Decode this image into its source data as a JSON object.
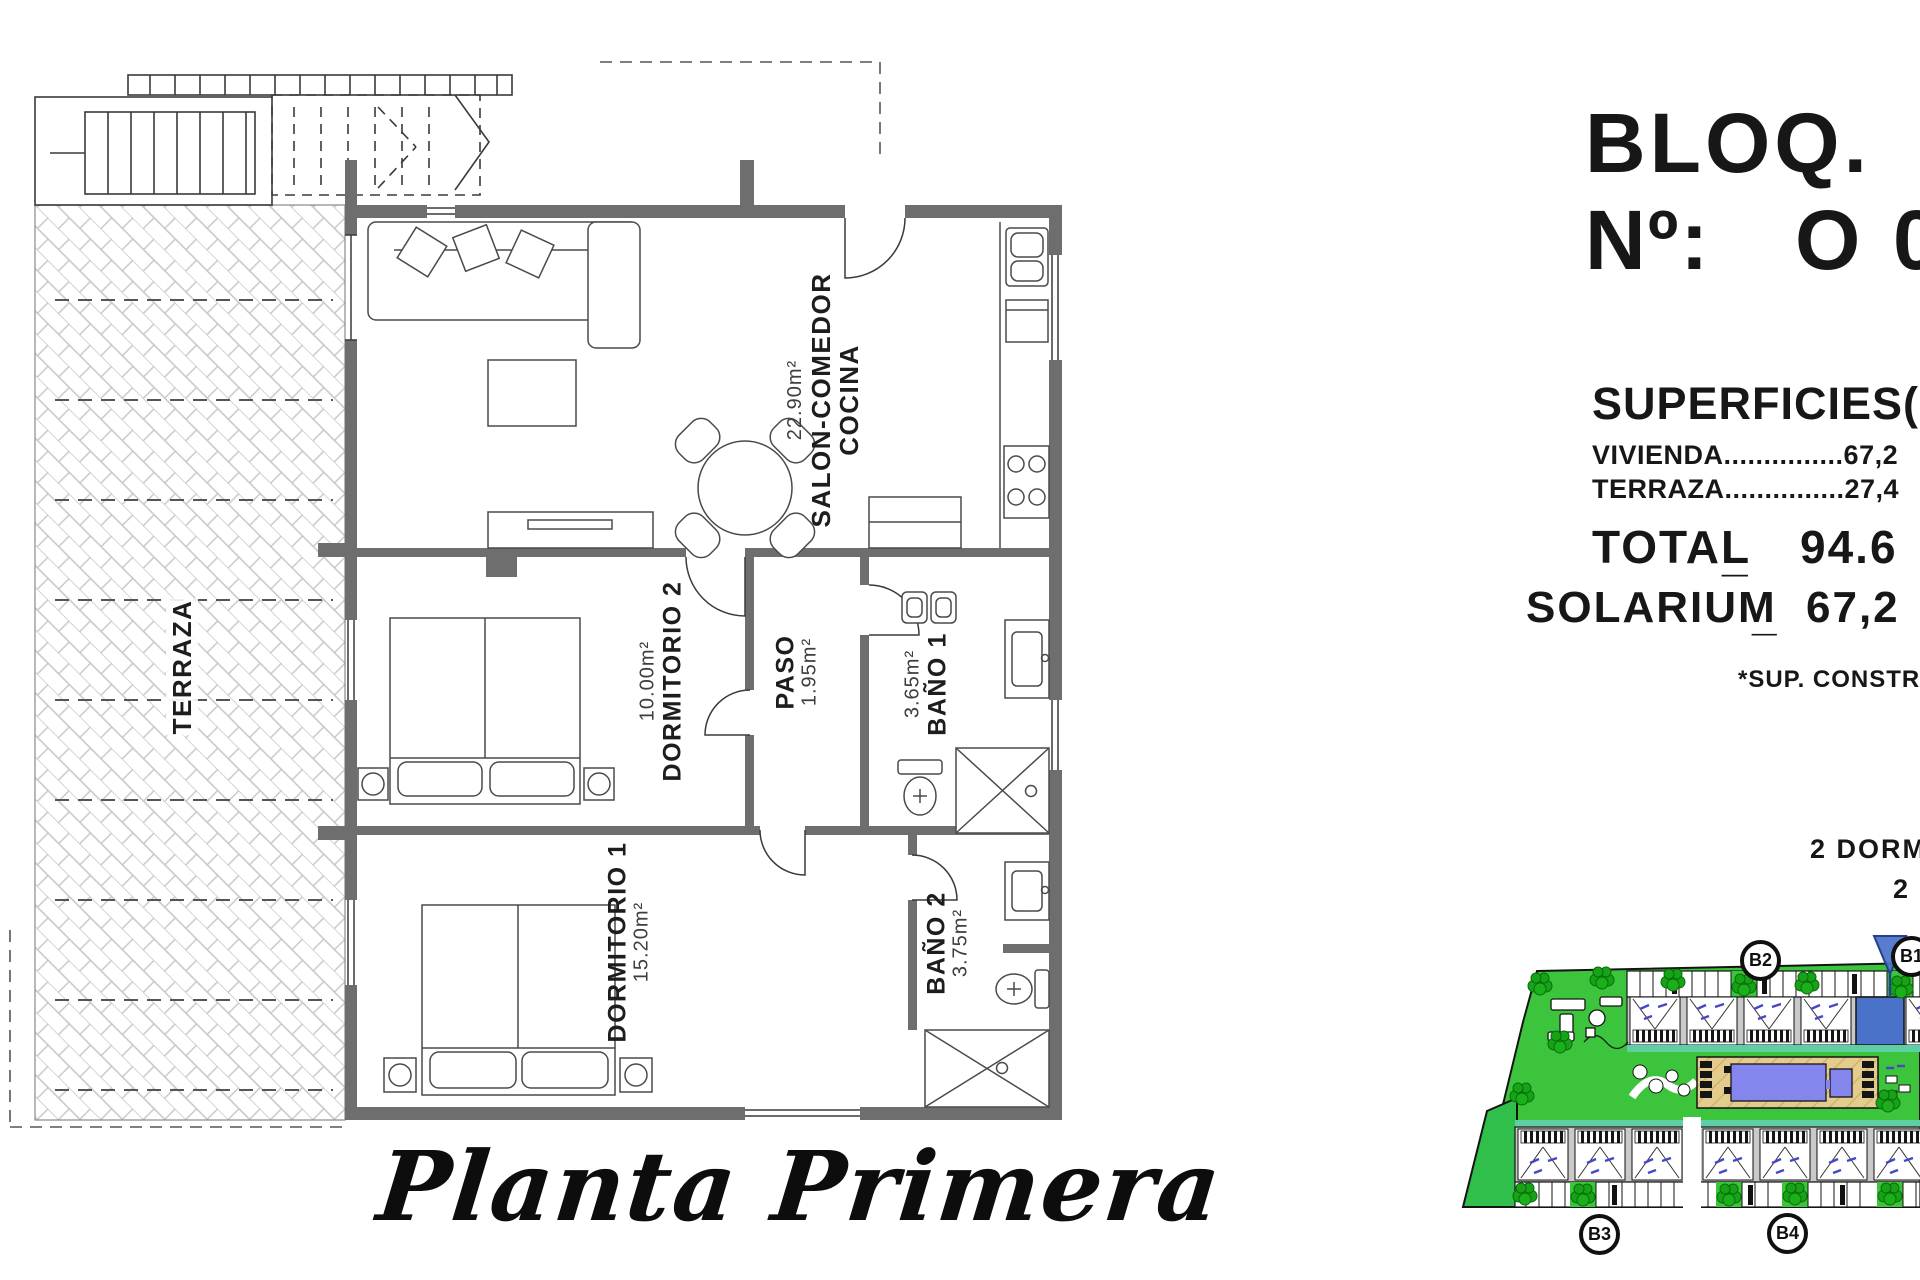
{
  "floor_plan": {
    "title": "Planta Primera",
    "rooms": {
      "salon": {
        "area": "22.90m²",
        "name_line1": "SALON-COMEDOR",
        "name_line2": "COCINA"
      },
      "dormitorio2": {
        "area": "10.00m²",
        "name": "DORMITORIO 2"
      },
      "paso": {
        "name": "PASO",
        "area": "1.95m²"
      },
      "bano1": {
        "area": "3.65m²",
        "name": "BAÑO 1"
      },
      "dormitorio1": {
        "name": "DORMITORIO 1",
        "area": "15.20m²"
      },
      "bano2": {
        "name": "BAÑO 2",
        "area": "3.75m²"
      },
      "terraza": {
        "name": "TERRAZA"
      }
    }
  },
  "info_panel": {
    "bloq_label": "BLOQ.",
    "numero_label": "Nº:",
    "numero_value": "O",
    "numero_value_cut": "0",
    "superficies_heading": "SUPERFICIES(M",
    "vivienda_line": "VIVIENDA...............67,2",
    "terraza_line": "TERRAZA...............27,4",
    "total_label": "TOTAL",
    "total_separator": "_",
    "total_value": "94.6",
    "solarium_label": "SOLARIUM",
    "solarium_separator": "_",
    "solarium_value": "67,2",
    "construida_note": "*SUP. CONSTRUID",
    "bedrooms_note": "2 DORMI",
    "baths_note": "2"
  },
  "site_plan": {
    "block_labels": {
      "b1": "B1",
      "b2": "B2",
      "b3": "B3",
      "b4": "B4"
    },
    "colors": {
      "grass_green": "#3cc53c",
      "accent_green": "#2fbf4a",
      "teal_strip": "#5ecfa5",
      "pool_blue": "#8585ee",
      "deck_tan": "#e3cc8e",
      "highlight_unit_blue": "#4a72c8",
      "building_gray": "#c9c9c9"
    }
  }
}
